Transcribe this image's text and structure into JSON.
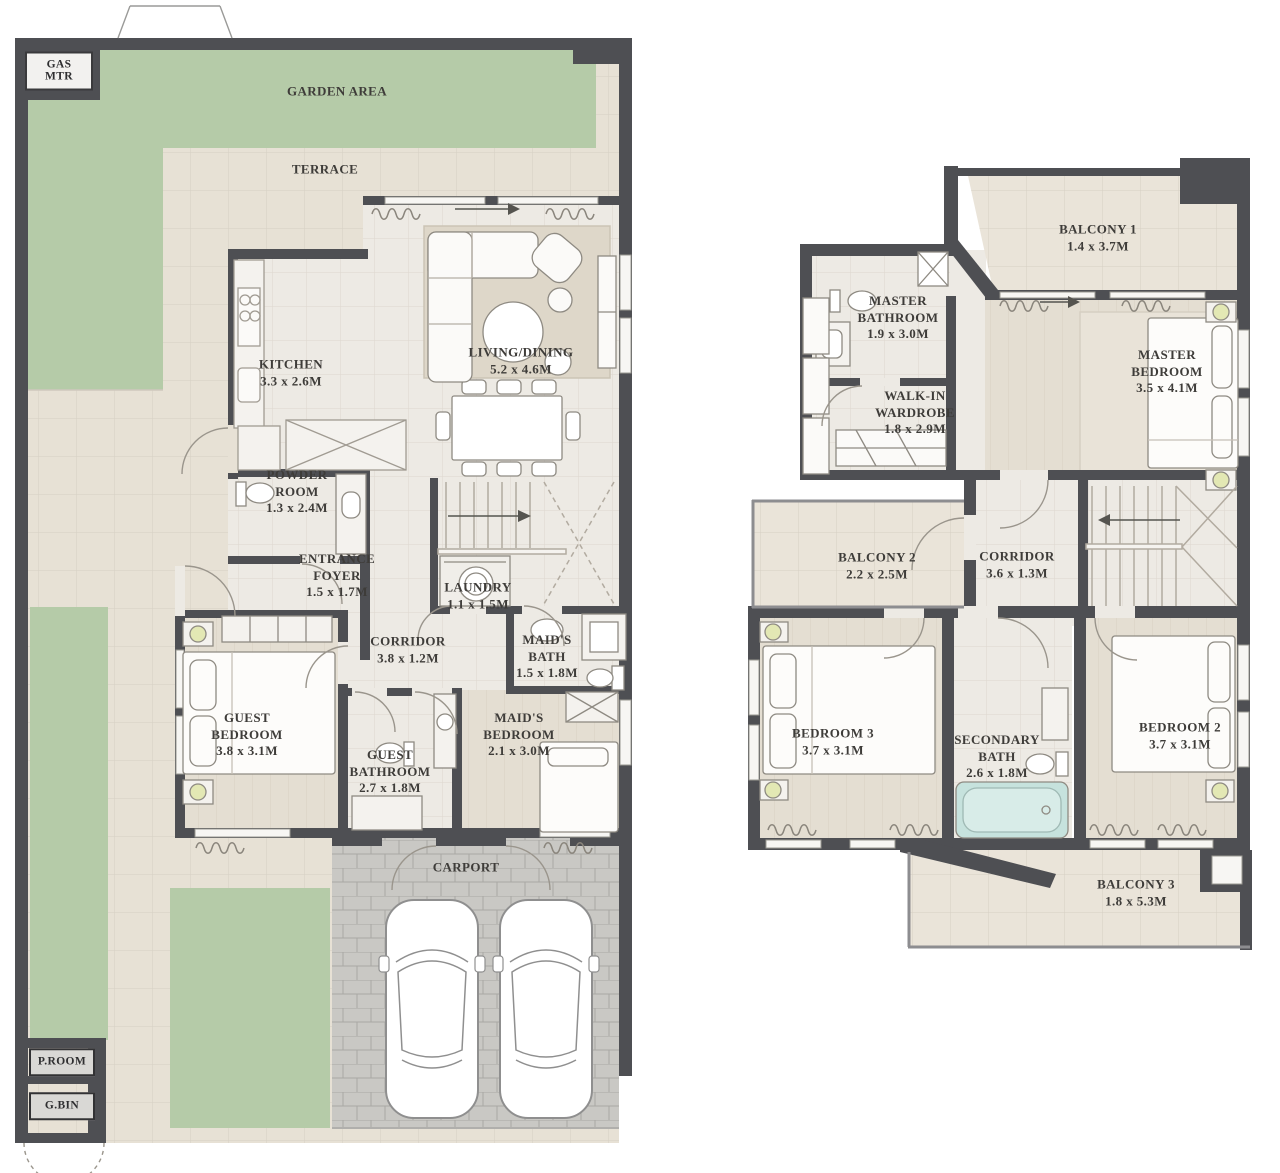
{
  "document": {
    "type": "residential floor plan, two storeys side by side",
    "colors": {
      "wall": "#4e4f53",
      "garden": "#b5cba8",
      "terrace_tile": "#e7e1d5",
      "interior_floor": "#edeae4",
      "wood_floor": "#e4ded2",
      "paver": "#c9c8c4",
      "rug": "#ded7c9",
      "bathtub": "#c6e2dd",
      "lamp": "#e3e8b4",
      "label_text": "#3e3c39"
    }
  },
  "floors": {
    "ground": {
      "badges": {
        "gas_mtr": "GAS MTR",
        "p_room": "P.ROOM",
        "g_bin": "G.BIN"
      },
      "rooms": {
        "garden": {
          "name": "GARDEN AREA",
          "dims": ""
        },
        "terrace": {
          "name": "TERRACE",
          "dims": ""
        },
        "kitchen": {
          "name": "KITCHEN",
          "dims": "3.3 x 2.6M"
        },
        "living_dining": {
          "name": "LIVING/DINING",
          "dims": "5.2 x 4.6M"
        },
        "powder_room": {
          "name": "POWDER ROOM",
          "dims": "1.3 x 2.4M"
        },
        "entrance_foyer": {
          "name": "ENTRANCE FOYER",
          "dims": "1.5 x 1.7M"
        },
        "laundry": {
          "name": "LAUNDRY",
          "dims": "1.1 x 1.5M"
        },
        "corridor": {
          "name": "CORRIDOR",
          "dims": "3.8 x 1.2M"
        },
        "maids_bath": {
          "name": "MAID'S BATH",
          "dims": "1.5 x 1.8M"
        },
        "guest_bedroom": {
          "name": "GUEST BEDROOM",
          "dims": "3.8 x 3.1M"
        },
        "guest_bathroom": {
          "name": "GUEST BATHROOM",
          "dims": "2.7 x 1.8M"
        },
        "maids_bedroom": {
          "name": "MAID'S BEDROOM",
          "dims": "2.1 x 3.0M"
        },
        "carport": {
          "name": "CARPORT",
          "dims": ""
        }
      }
    },
    "first": {
      "rooms": {
        "balcony1": {
          "name": "BALCONY 1",
          "dims": "1.4 x 3.7M"
        },
        "master_bathroom": {
          "name": "MASTER BATHROOM",
          "dims": "1.9 x 3.0M"
        },
        "master_bedroom": {
          "name": "MASTER BEDROOM",
          "dims": "3.5 x 4.1M"
        },
        "walk_in_wardrobe": {
          "name": "WALK-IN WARDROBE",
          "dims": "1.8 x 2.9M"
        },
        "balcony2": {
          "name": "BALCONY 2",
          "dims": "2.2 x 2.5M"
        },
        "corridor": {
          "name": "CORRIDOR",
          "dims": "3.6 x 1.3M"
        },
        "bedroom3": {
          "name": "BEDROOM 3",
          "dims": "3.7 x 3.1M"
        },
        "secondary_bath": {
          "name": "SECONDARY BATH",
          "dims": "2.6 x 1.8M"
        },
        "bedroom2": {
          "name": "BEDROOM 2",
          "dims": "3.7 x 3.1M"
        },
        "balcony3": {
          "name": "BALCONY 3",
          "dims": "1.8 x 5.3M"
        }
      }
    }
  }
}
